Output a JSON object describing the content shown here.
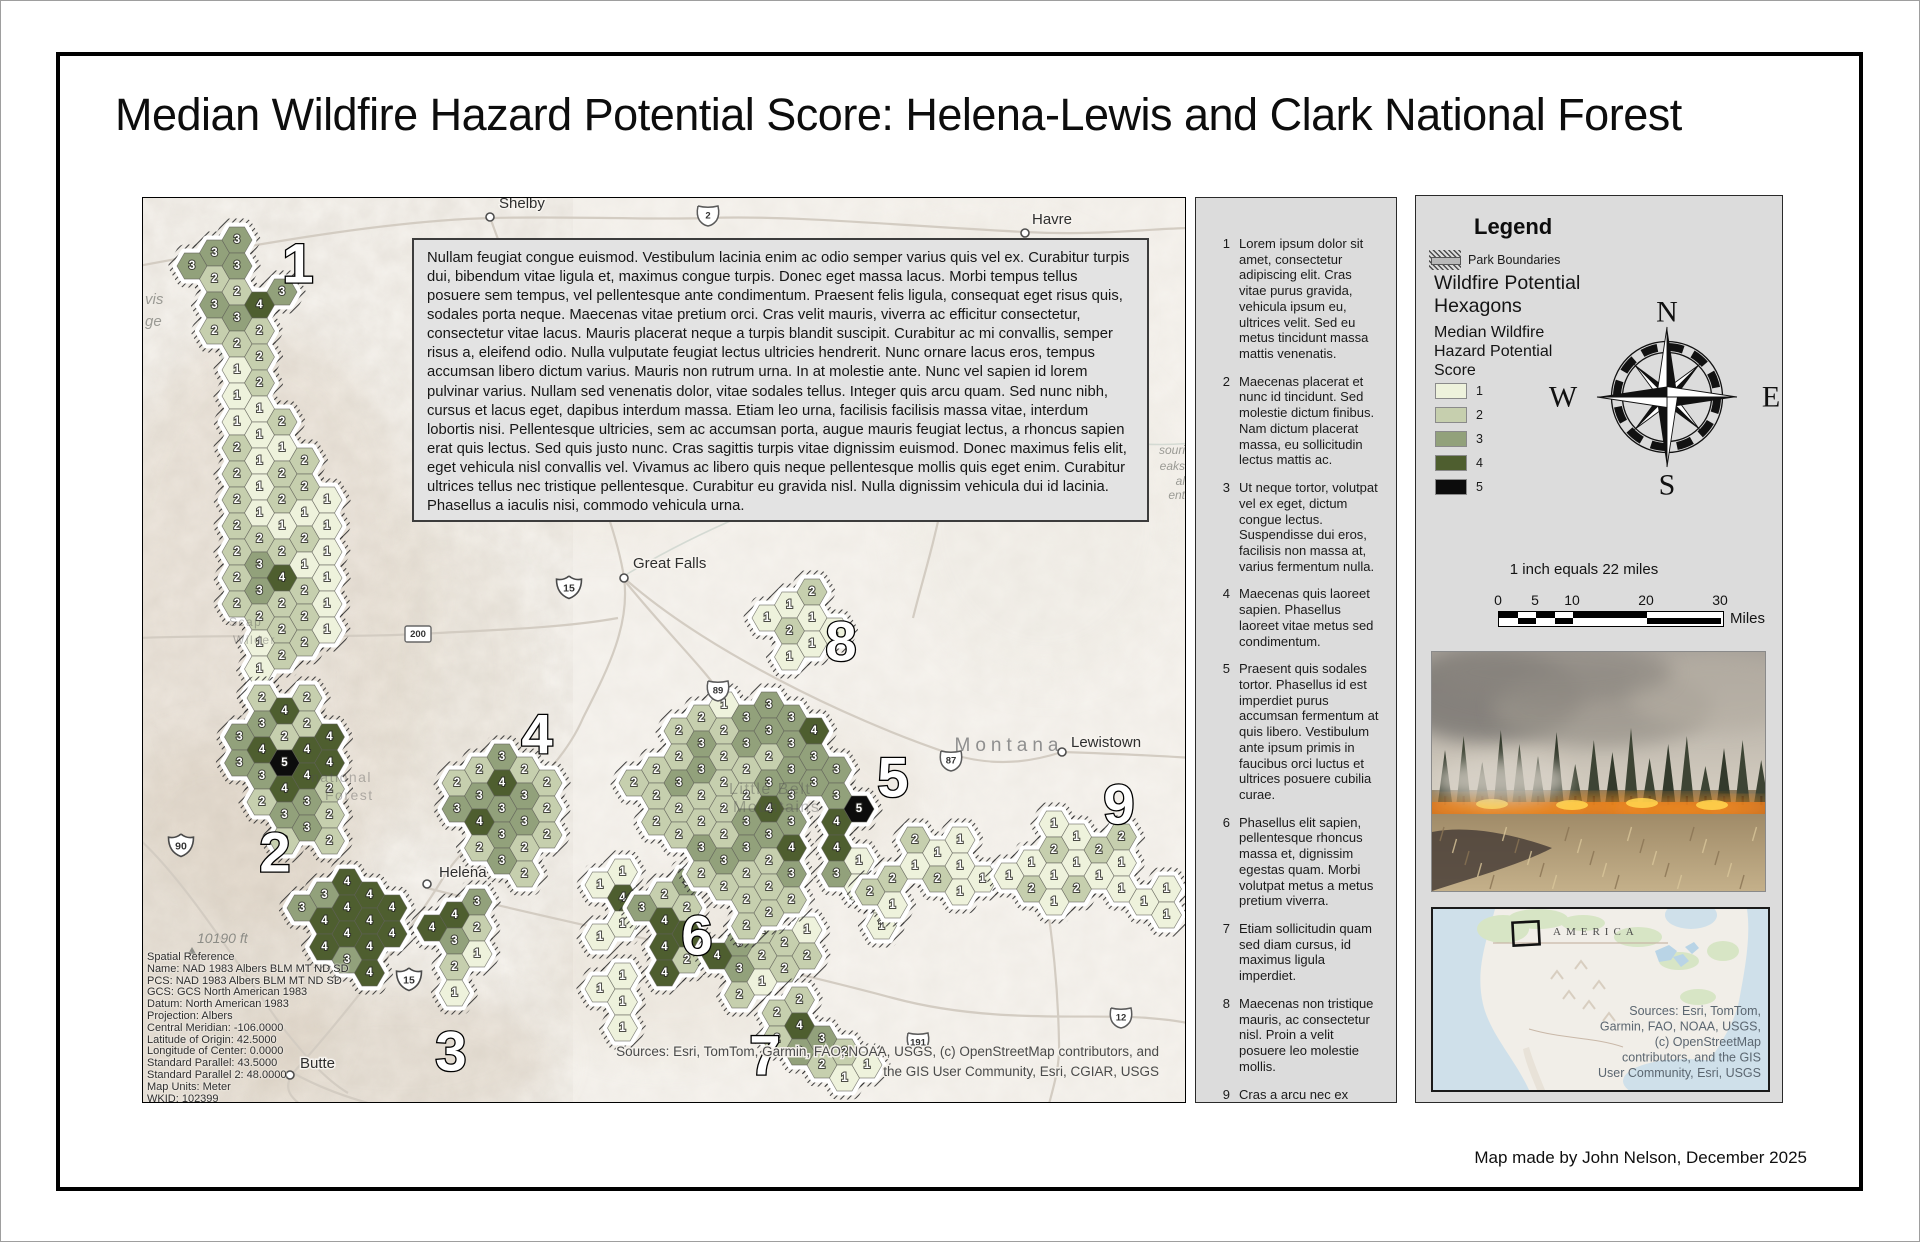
{
  "title": "Median Wildfire Hazard Potential Score: Helena-Lewis and Clark National Forest",
  "credit": "Map made by John Nelson, December 2025",
  "map": {
    "description": "Nullam feugiat congue euismod. Vestibulum lacinia enim ac odio semper varius quis vel ex. Curabitur turpis dui, bibendum vitae ligula et, maximus congue turpis. Donec eget massa lacus. Morbi tempus tellus posuere sem tempus, vel pellentesque ante condimentum. Praesent felis ligula, consequat eget risus quis, sodales porta neque. Maecenas vitae pretium orci. Cras velit mauris, viverra ac efficitur consectetur, consectetur vitae lacus. Mauris placerat neque a turpis blandit suscipit. Curabitur ac mi convallis, semper risus a, eleifend odio. Nulla vulputate feugiat lectus ultricies hendrerit. Nunc ornare lacus eros, tempus accumsan libero dictum varius. Mauris non rutrum urna. In at molestie ante. Nunc vel sapien id lorem pulvinar varius. Nullam sed venenatis dolor, vitae sodales tellus. Integer quis arcu quam. Sed nunc nibh, cursus et lacus eget, dapibus interdum massa. Etiam leo urna, facilisis facilisis massa vitae, interdum lobortis nisi. Pellentesque ultricies, sem ac accumsan porta, augue mauris feugiat lectus, a rhoncus sapien erat quis lectus. Sed quis justo nunc. Cras sagittis turpis vitae dignissim euismod. Donec maximus felis elit, eget vehicula nisl convallis vel. Vivamus ac libero quis neque pellentesque mollis quis eget enim. Curabitur ultrices tellus nec tristique pellentesque. Curabitur eu gravida nisl. Nulla dignissim vehicula dui id lacinia. Phasellus a iaculis nisi, commodo vehicula urna.",
    "attribution_lines": [
      "Sources:  Esri, TomTom, Garmin, FAO, NOAA, USGS, (c) OpenStreetMap contributors, and",
      "the GIS User Community, Esri, CGIAR, USGS"
    ],
    "spatial_reference": [
      "Spatial Reference",
      "Name: NAD 1983 Albers BLM MT ND SD",
      "PCS: NAD 1983 Albers BLM MT ND SD",
      "GCS: GCS North American 1983",
      "Datum: North American 1983",
      "Projection: Albers",
      "Central Meridian: -106.0000",
      "Latitude of Origin: 42.5000",
      "Longitude of Center: 0.0000",
      "Standard Parallel: 43.5000",
      "Standard Parallel 2: 48.0000",
      "Map Units: Meter",
      "WKID: 102399"
    ],
    "state_label": {
      "text": "Montana",
      "x": 866,
      "y": 553
    },
    "elevation_label": {
      "text": "10190 ft",
      "x": 54,
      "y": 745
    },
    "cities": [
      {
        "name": "Shelby",
        "x": 347,
        "y": 19,
        "lx": 356,
        "ly": 10
      },
      {
        "name": "Havre",
        "x": 882,
        "y": 35,
        "lx": 889,
        "ly": 26
      },
      {
        "name": "Great Falls",
        "x": 481,
        "y": 380,
        "lx": 490,
        "ly": 370
      },
      {
        "name": "Helena",
        "x": 284,
        "y": 686,
        "lx": 296,
        "ly": 679
      },
      {
        "name": "Butte",
        "x": 147,
        "y": 877,
        "lx": 157,
        "ly": 870
      },
      {
        "name": "Lewistown",
        "x": 919,
        "y": 554,
        "lx": 928,
        "ly": 549
      }
    ],
    "shields": [
      {
        "t": "us",
        "n": "2",
        "x": 565,
        "y": 17
      },
      {
        "t": "i",
        "n": "15",
        "x": 426,
        "y": 389
      },
      {
        "t": "rect",
        "n": "200",
        "x": 275,
        "y": 436
      },
      {
        "t": "us",
        "n": "89",
        "x": 575,
        "y": 492
      },
      {
        "t": "us",
        "n": "87",
        "x": 808,
        "y": 562
      },
      {
        "t": "i",
        "n": "90",
        "x": 38,
        "y": 647
      },
      {
        "t": "i",
        "n": "15",
        "x": 266,
        "y": 781
      },
      {
        "t": "us",
        "n": "12",
        "x": 978,
        "y": 819
      },
      {
        "t": "us",
        "n": "191",
        "x": 775,
        "y": 844
      }
    ],
    "region_labels": [
      {
        "n": "1",
        "x": 155,
        "y": 65
      },
      {
        "n": "2",
        "x": 132,
        "y": 654
      },
      {
        "n": "3",
        "x": 308,
        "y": 853
      },
      {
        "n": "4",
        "x": 394,
        "y": 536
      },
      {
        "n": "5",
        "x": 750,
        "y": 579
      },
      {
        "n": "6",
        "x": 554,
        "y": 737
      },
      {
        "n": "7",
        "x": 622,
        "y": 857
      },
      {
        "n": "8",
        "x": 698,
        "y": 443
      },
      {
        "n": "9",
        "x": 976,
        "y": 606
      }
    ],
    "edge_labels": [
      {
        "t": "vis",
        "x": 2,
        "y": 106,
        "serif": true
      },
      {
        "t": "ge",
        "x": 2,
        "y": 128,
        "serif": true
      },
      {
        "t": "souri",
        "x": 1042,
        "y": 256,
        "end": true
      },
      {
        "t": "eaks",
        "x": 1042,
        "y": 272,
        "end": true
      },
      {
        "t": "al",
        "x": 1042,
        "y": 287,
        "end": true
      },
      {
        "t": "ent",
        "x": 1042,
        "y": 301,
        "end": true
      }
    ],
    "faint_labels": [
      {
        "t": "Scap",
        "x": 86,
        "y": 428,
        "s": 12
      },
      {
        "t": "Wilder",
        "x": 90,
        "y": 446,
        "s": 12
      },
      {
        "t": "national",
        "x": 168,
        "y": 584,
        "s": 14
      },
      {
        "t": "Forest",
        "x": 182,
        "y": 602,
        "s": 14
      },
      {
        "t": "Little Belt",
        "x": 586,
        "y": 596,
        "s": 16
      },
      {
        "t": "Mountains",
        "x": 590,
        "y": 614,
        "s": 16
      }
    ],
    "score_colors": {
      "1": "#eef2dc",
      "2": "#c6cfae",
      "3": "#92a17b",
      "4": "#4e5e2f",
      "5": "#0c0c0c"
    },
    "clusters": [
      {
        "x": 49,
        "y": 42,
        "rows": [
          " 33",
          "323",
          " 3243",
          " 232",
          "  22",
          "  12",
          "  11",
          "  112",
          "  2112",
          "  2122",
          "  21211",
          "  22121",
          "  23211",
          "  23421",
          "  22221",
          "   1221",
          "   12",
          "   1"
        ]
      },
      {
        "x": 74,
        "y": 500,
        "rows": [
          "  242",
          " 33224",
          " 34544",
          "  3442",
          "  2332",
          "   232"
        ]
      },
      {
        "x": 159,
        "y": 684,
        "rows": [
          " 344",
          "34444",
          " 4444",
          "  34"
        ]
      },
      {
        "x": 289,
        "y": 704,
        "rows": [
          " 43",
          "432",
          " 21",
          " 1"
        ]
      },
      {
        "x": 314,
        "y": 559,
        "rows": [
          " 232",
          "23432",
          "34332",
          " 2322",
          "  32"
        ]
      },
      {
        "x": 457,
        "y": 661,
        "rows": [
          " 1",
          "14",
          " 1",
          "1",
          " 1",
          "11",
          " 1"
        ]
      },
      {
        "x": 499,
        "y": 684,
        "rows": [
          " 23",
          "342",
          " 44",
          " 42"
        ]
      },
      {
        "x": 574,
        "y": 706,
        "rows": [
          "  1",
          " 3221",
          "43222",
          " 21"
        ]
      },
      {
        "x": 634,
        "y": 789,
        "rows": [
          " 2",
          "24",
          "2332",
          "  211"
        ]
      },
      {
        "x": 624,
        "y": 394,
        "rows": [
          " 12",
          "1211",
          " 11"
        ]
      },
      {
        "x": 491,
        "y": 507,
        "rows": [
          "   21333",
          "  2323334",
          " 223222333",
          "2232223333",
          " 2222343 45",
          "  232334 4",
          "   23223 31",
          "    2222  11",
          "     22    1"
        ]
      },
      {
        "x": 727,
        "y": 642,
        "rows": [
          "  211",
          " 21211",
          "21  1"
        ]
      },
      {
        "x": 866,
        "y": 626,
        "rows": [
          "  11 2",
          " 12121",
          "121211 1",
          "  1   11"
        ]
      }
    ]
  },
  "notes_panel": {
    "items": [
      {
        "n": "1",
        "text": "Lorem ipsum dolor sit amet, consectetur adipiscing elit. Cras vitae purus gravida, vehicula ipsum eu, ultrices velit. Sed eu metus tincidunt massa mattis venenatis."
      },
      {
        "n": "2",
        "text": "Maecenas placerat et nunc id tincidunt. Sed molestie dictum finibus. Nam dictum placerat massa, eu sollicitudin lectus mattis ac."
      },
      {
        "n": "3",
        "text": "Ut neque tortor, volutpat vel ex eget, dictum congue lectus. Suspendisse dui eros, facilisis non massa at, varius fermentum nulla."
      },
      {
        "n": "4",
        "text": "Maecenas quis laoreet sapien. Phasellus laoreet vitae metus sed condimentum."
      },
      {
        "n": "5",
        "text": "Praesent quis sodales tortor. Phasellus id est imperdiet purus accumsan fermentum at quis libero. Vestibulum ante ipsum primis in faucibus orci luctus et ultrices posuere cubilia curae."
      },
      {
        "n": "6",
        "text": "Phasellus elit sapien, pellentesque rhoncus massa et, dignissim egestas quam. Morbi volutpat metus a metus pretium viverra."
      },
      {
        "n": "7",
        "text": "Etiam sollicitudin quam sed diam cursus, id maximus ligula imperdiet."
      },
      {
        "n": "8",
        "text": "Maecenas non tristique mauris, ac consectetur nisl. Proin a velit posuere leo molestie mollis."
      },
      {
        "n": "9",
        "text": "Cras a arcu nec ex pharetra mollis. Vivamus pulvinar ultricies lectus. Morbi sit amet elementum ante."
      }
    ]
  },
  "legend": {
    "title": "Legend",
    "park_boundaries_label": "Park Boundaries",
    "layer_title": "Wildfire Potential Hexagons",
    "score_title": "Median Wildfire Hazard Potential Score",
    "classes": [
      {
        "value": "1",
        "color": "#eef2dc"
      },
      {
        "value": "2",
        "color": "#c6cfae"
      },
      {
        "value": "3",
        "color": "#92a17b"
      },
      {
        "value": "4",
        "color": "#4e5e2f"
      },
      {
        "value": "5",
        "color": "#0c0c0c"
      }
    ],
    "compass_letters": {
      "n": "N",
      "e": "E",
      "s": "S",
      "w": "W"
    },
    "scale_text": "1 inch equals 22 miles",
    "scale_ticks": [
      "0",
      "5",
      "10",
      "20",
      "30"
    ],
    "scale_total_miles": 30,
    "scale_divisions": [
      0,
      2.5,
      5,
      7.5,
      10,
      20,
      30
    ],
    "scale_unit": "Miles",
    "inset": {
      "label": "AMERICA",
      "sources_lines": [
        "Sources:  Esri, TomTom,",
        "Garmin, FAO, NOAA, USGS,",
        "(c) OpenStreetMap",
        "contributors, and the GIS",
        "User Community, Esri, USGS"
      ]
    }
  }
}
